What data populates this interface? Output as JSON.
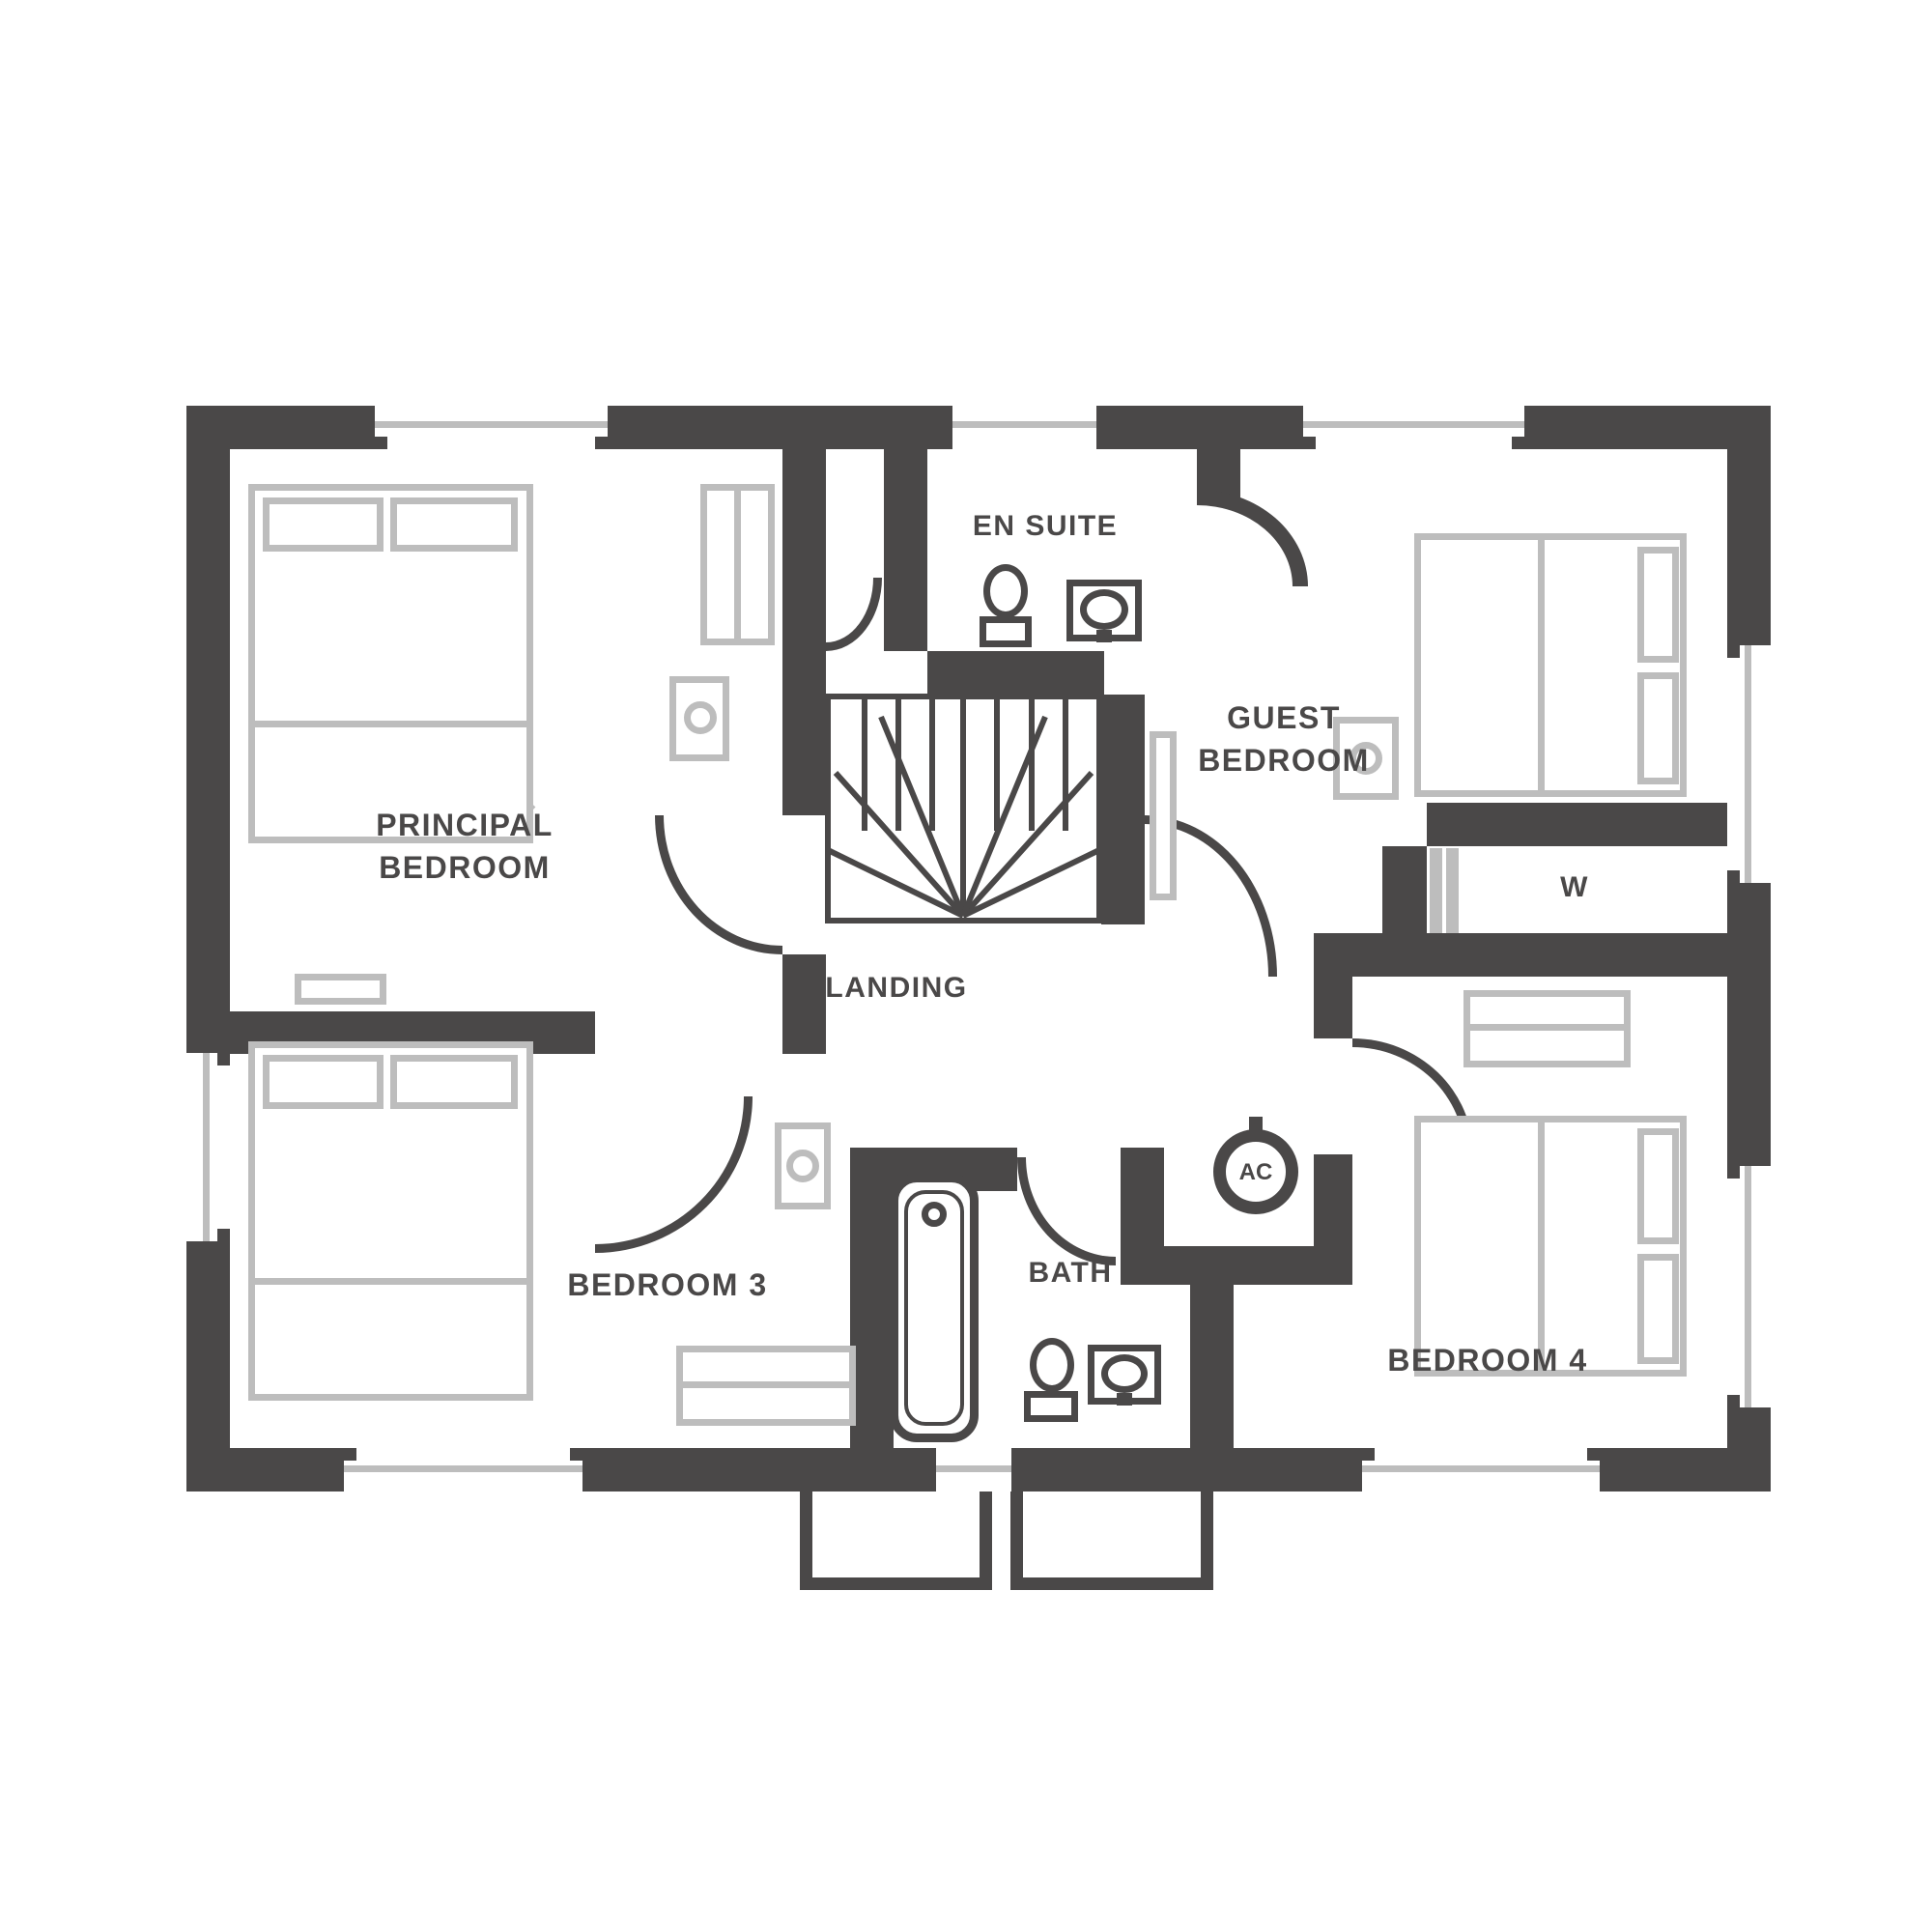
{
  "colors": {
    "wall": "#4a4848",
    "furniture": "#bdbdbd",
    "background": "#ffffff"
  },
  "rooms": {
    "principal_bedroom": {
      "label_line1": "PRINCIPAL",
      "label_line2": "BEDROOM"
    },
    "guest_bedroom": {
      "label_line1": "GUEST",
      "label_line2": "BEDROOM"
    },
    "bedroom3": {
      "label": "BEDROOM 3"
    },
    "bedroom4": {
      "label": "BEDROOM 4"
    },
    "en_suite": {
      "label": "EN SUITE"
    },
    "landing": {
      "label": "LANDING"
    },
    "bath": {
      "label": "BATH"
    },
    "wardrobe_cupboard": {
      "label": "W"
    },
    "airing_cupboard": {
      "label": "AC"
    }
  }
}
